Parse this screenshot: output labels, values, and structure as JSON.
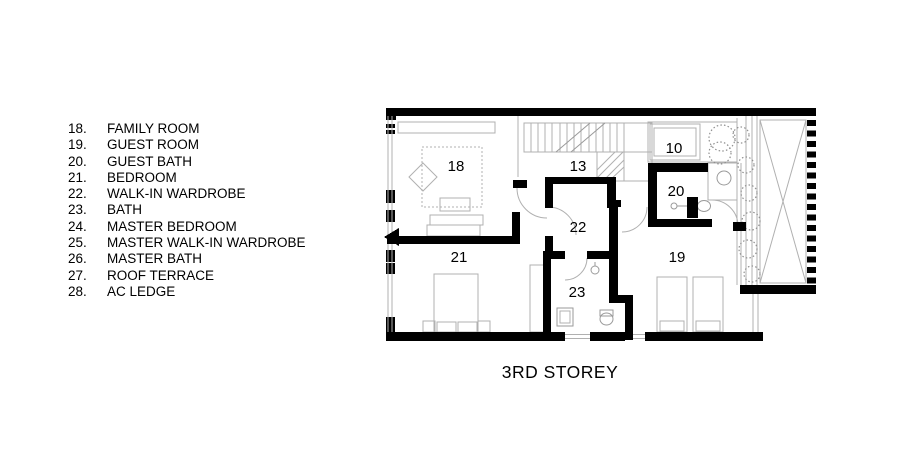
{
  "legend": {
    "items": [
      {
        "number": "18.",
        "label": "FAMILY ROOM"
      },
      {
        "number": "19.",
        "label": "GUEST ROOM"
      },
      {
        "number": "20.",
        "label": "GUEST BATH"
      },
      {
        "number": "21.",
        "label": "BEDROOM"
      },
      {
        "number": "22.",
        "label": "WALK-IN WARDROBE"
      },
      {
        "number": "23.",
        "label": "BATH"
      },
      {
        "number": "24.",
        "label": "MASTER BEDROOM"
      },
      {
        "number": "25.",
        "label": "MASTER WALK-IN WARDROBE"
      },
      {
        "number": "26.",
        "label": "MASTER BATH"
      },
      {
        "number": "27.",
        "label": "ROOF TERRACE"
      },
      {
        "number": "28.",
        "label": "AC LEDGE"
      }
    ]
  },
  "plan": {
    "title": "3RD STOREY",
    "room_labels": {
      "family_room": "18",
      "stair_hall": "13",
      "void": "10",
      "guest_bath": "20",
      "walk_in_wardrobe": "22",
      "bedroom": "21",
      "guest_room": "19",
      "bath": "23"
    }
  },
  "colors": {
    "wall": "#000000",
    "thin_line": "#b0b0b0",
    "text": "#000000",
    "background": "#ffffff"
  }
}
